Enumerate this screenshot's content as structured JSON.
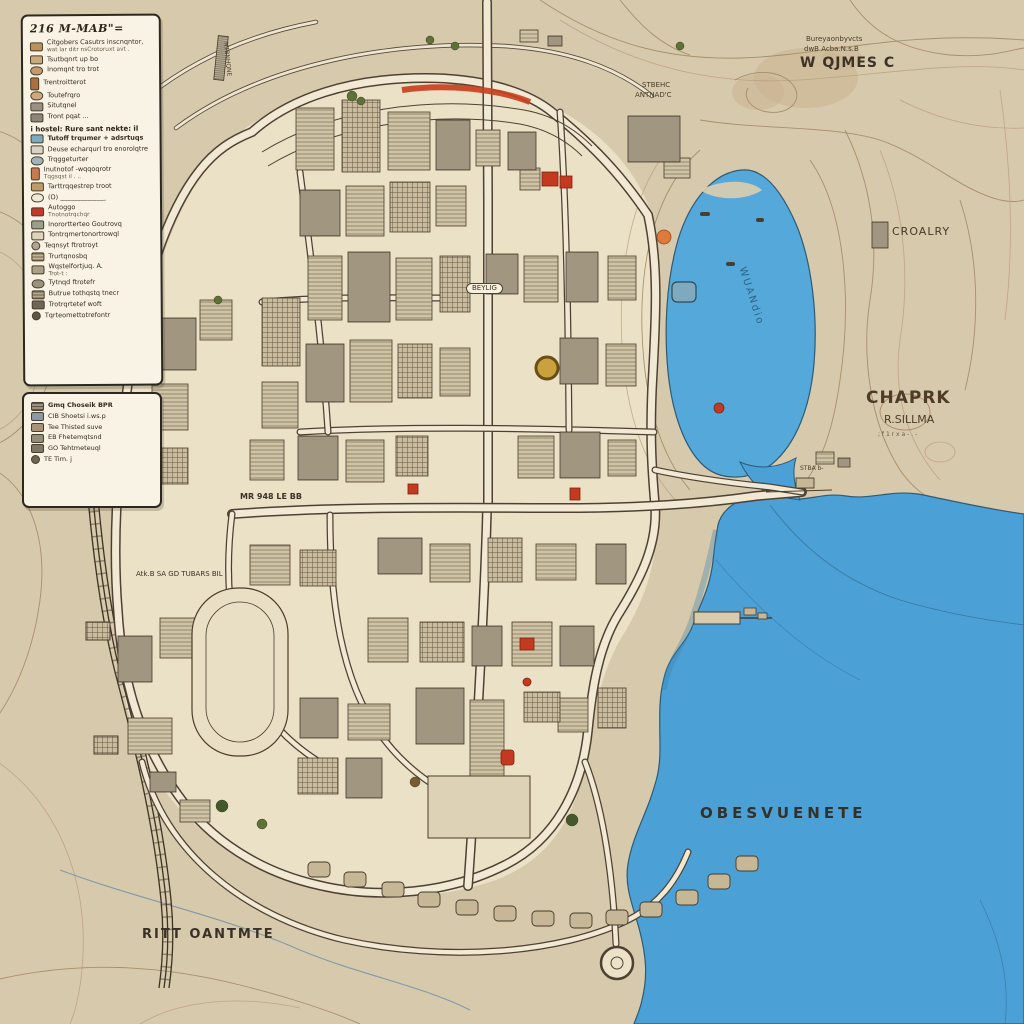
{
  "colors": {
    "terrain": "#d7c9ab",
    "city_fill": "#ebe1c7",
    "water": "#4ba1d6",
    "road_fill": "#f1e9d3",
    "road_casing": "#4e4134",
    "contour": "#a18a65",
    "legend_bg": "#f8f3e4",
    "accent_red": "#c23a20",
    "accent_orange": "#df7a3e",
    "accent_teal": "#7fa9bd",
    "accent_gold": "#caa13f",
    "label_ink": "#3c3226"
  },
  "legend": {
    "boxes": [
      {
        "title": "216 M-MAB\"=",
        "items": [
          {
            "shape": "rect",
            "color": "#b9905e",
            "label": "Citgobers Casutrs inscnqntor,",
            "label2": "wat lar ditr nsCrotoruxt avt ."
          },
          {
            "shape": "rect",
            "color": "#c8ab7d",
            "label": "Tsutbqnrt up bo"
          },
          {
            "shape": "oval",
            "color": "#c49a6c",
            "label": "Inomqnt tro trot"
          },
          {
            "shape": "tall",
            "color": "#a9713f",
            "label": "Trentroitterot"
          },
          {
            "shape": "oval",
            "color": "#cda97e",
            "label": "Toutefrqro"
          },
          {
            "shape": "rect",
            "color": "#9a9183",
            "label": "Situtqnel"
          },
          {
            "shape": "rect",
            "color": "#8d857a",
            "label": "Tront pqat ..."
          },
          {
            "header": true,
            "label": "i hostel: Rure sant nekte: il"
          },
          {
            "shape": "rect",
            "color": "#7fa9bd",
            "label": "Tutoff trqumer + adsrtuqs",
            "bold": true
          },
          {
            "shape": "rect",
            "color": "#d8d2c4",
            "label": "Deuse echarqurl tro enorolqtre"
          },
          {
            "shape": "oval",
            "color": "#9db4b8",
            "label": "Trqggeturter"
          },
          {
            "shape": "tall",
            "color": "#c87b4e",
            "label": "Inutnotof -wqqoqrotr",
            "label2": "Tqgsqst il . .."
          },
          {
            "shape": "rect",
            "color": "#bf9a6a",
            "label": "Tarttrqqestrep troot"
          },
          {
            "shape": "oval",
            "color": "#efe9d8",
            "label": "(O) ______________"
          },
          {
            "shape": "rect",
            "color": "#c0392b",
            "label": "Autoggo",
            "label2": "Tnotnotrqchqr"
          },
          {
            "shape": "rect",
            "color": "#9aa08b",
            "label": "Inorortterteo Goutrovq"
          },
          {
            "shape": "rect",
            "color": "#ded3bd",
            "label": "Tontrqmertonortrowql"
          },
          {
            "shape": "circle",
            "color": "#b0a692",
            "label": "Teqnsyt ftrotroyt"
          },
          {
            "shape": "lines",
            "color": "#c4b596",
            "label": "Trurtqnosbq"
          },
          {
            "shape": "rect",
            "color": "#aba188",
            "label": "Wqstelfortjuq. A.",
            "label2": "Trot-t :"
          },
          {
            "shape": "oval",
            "color": "#9b927f",
            "label": "Tytnqd ftrotefr"
          },
          {
            "shape": "lines",
            "color": "#b3a98e",
            "label": "Butrue tothqstq tnecr"
          },
          {
            "shape": "rect",
            "color": "#6f6657",
            "label": "Trotrqrtetef woft"
          },
          {
            "shape": "circle",
            "color": "#5d5546",
            "label": "Tqrteomettotrefontr"
          }
        ]
      },
      {
        "title": "",
        "items": [
          {
            "shape": "lines",
            "color": "#9a9183",
            "label": "Gmq Choseik BPR",
            "bold": true
          },
          {
            "shape": "rect",
            "color": "#8d98a5",
            "label": "CIB Shoetsi i.ws.p"
          },
          {
            "shape": "rect",
            "color": "#a8937a",
            "label": "Tee Thisted suve"
          },
          {
            "shape": "rect",
            "color": "#958d7c",
            "label": "EB Fhetemqtsnd"
          },
          {
            "shape": "rect",
            "color": "#7e7666",
            "label": "GO Tehtmeteuql"
          },
          {
            "shape": "circle",
            "color": "#6d6555",
            "label": "TE Tim. j"
          }
        ]
      }
    ]
  },
  "map": {
    "labels": [
      {
        "id": "region-note-1",
        "text": "Bureyaonbyvcts",
        "x": 806,
        "y": 36,
        "size": 7,
        "color": "#4a3d2c"
      },
      {
        "id": "region-note-2",
        "text": "dwB Acba.N.s.B",
        "x": 804,
        "y": 46,
        "size": 7,
        "color": "#4a3d2c"
      },
      {
        "id": "region-name",
        "text": "W QJMES C",
        "x": 800,
        "y": 56,
        "size": 14,
        "weight": 700,
        "ls": 1,
        "color": "#3c3226"
      },
      {
        "id": "croalry-label",
        "text": "CROALRY",
        "x": 892,
        "y": 226,
        "size": 11,
        "ls": 1,
        "color": "#473a28"
      },
      {
        "id": "chaprk-label",
        "text": "CHAPRK",
        "x": 866,
        "y": 390,
        "size": 17,
        "ls": 1,
        "weight": 600,
        "color": "#4c3c28"
      },
      {
        "id": "chaprk-sub",
        "text": "R.SILLMA",
        "x": 884,
        "y": 414,
        "size": 11,
        "color": "#4c3c28"
      },
      {
        "id": "chaprk-note",
        "text": "; f 1 r x a - . -",
        "x": 878,
        "y": 432,
        "size": 6,
        "color": "#6a5a42"
      },
      {
        "id": "sea-name",
        "text": "OBESVUENETE",
        "x": 700,
        "y": 806,
        "size": 15,
        "ls": 4,
        "weight": 600,
        "color": "#34302a"
      },
      {
        "id": "district-name",
        "text": "RITT OANTMTE",
        "x": 142,
        "y": 928,
        "size": 13,
        "ls": 2,
        "weight": 600,
        "color": "#3a3126"
      },
      {
        "id": "lagoon-name",
        "text": "WUANdio",
        "x": 746,
        "y": 266,
        "size": 10,
        "rotate": 72,
        "ls": 2,
        "color": "#2f6387"
      },
      {
        "id": "road-name-1",
        "text": "MR 948 LE BB",
        "x": 240,
        "y": 493,
        "size": 8,
        "weight": 600,
        "color": "#3a3126"
      },
      {
        "id": "road-name-2",
        "text": "Atk.B SA GD TUBARS BIL",
        "x": 136,
        "y": 571,
        "size": 7,
        "color": "#3a3126"
      },
      {
        "id": "road-name-3",
        "text": "STBEHC",
        "x": 642,
        "y": 82,
        "size": 7,
        "color": "#4a3d2c"
      },
      {
        "id": "road-name-4",
        "text": "ANTNAD'C",
        "x": 635,
        "y": 92,
        "size": 7,
        "color": "#4a3d2c"
      },
      {
        "id": "road-pill-label",
        "text": "BEYLIG",
        "x": 466,
        "y": 283,
        "size": 7,
        "pill": true,
        "color": "#3a3126"
      },
      {
        "id": "strip-label",
        "text": "NTBNHQNE",
        "x": 228,
        "y": 42,
        "size": 6,
        "rotate": 84,
        "color": "#4a3d2c"
      },
      {
        "id": "dock-note",
        "text": "STBA b-",
        "x": 800,
        "y": 466,
        "size": 6,
        "color": "#4a3d2c"
      }
    ]
  }
}
